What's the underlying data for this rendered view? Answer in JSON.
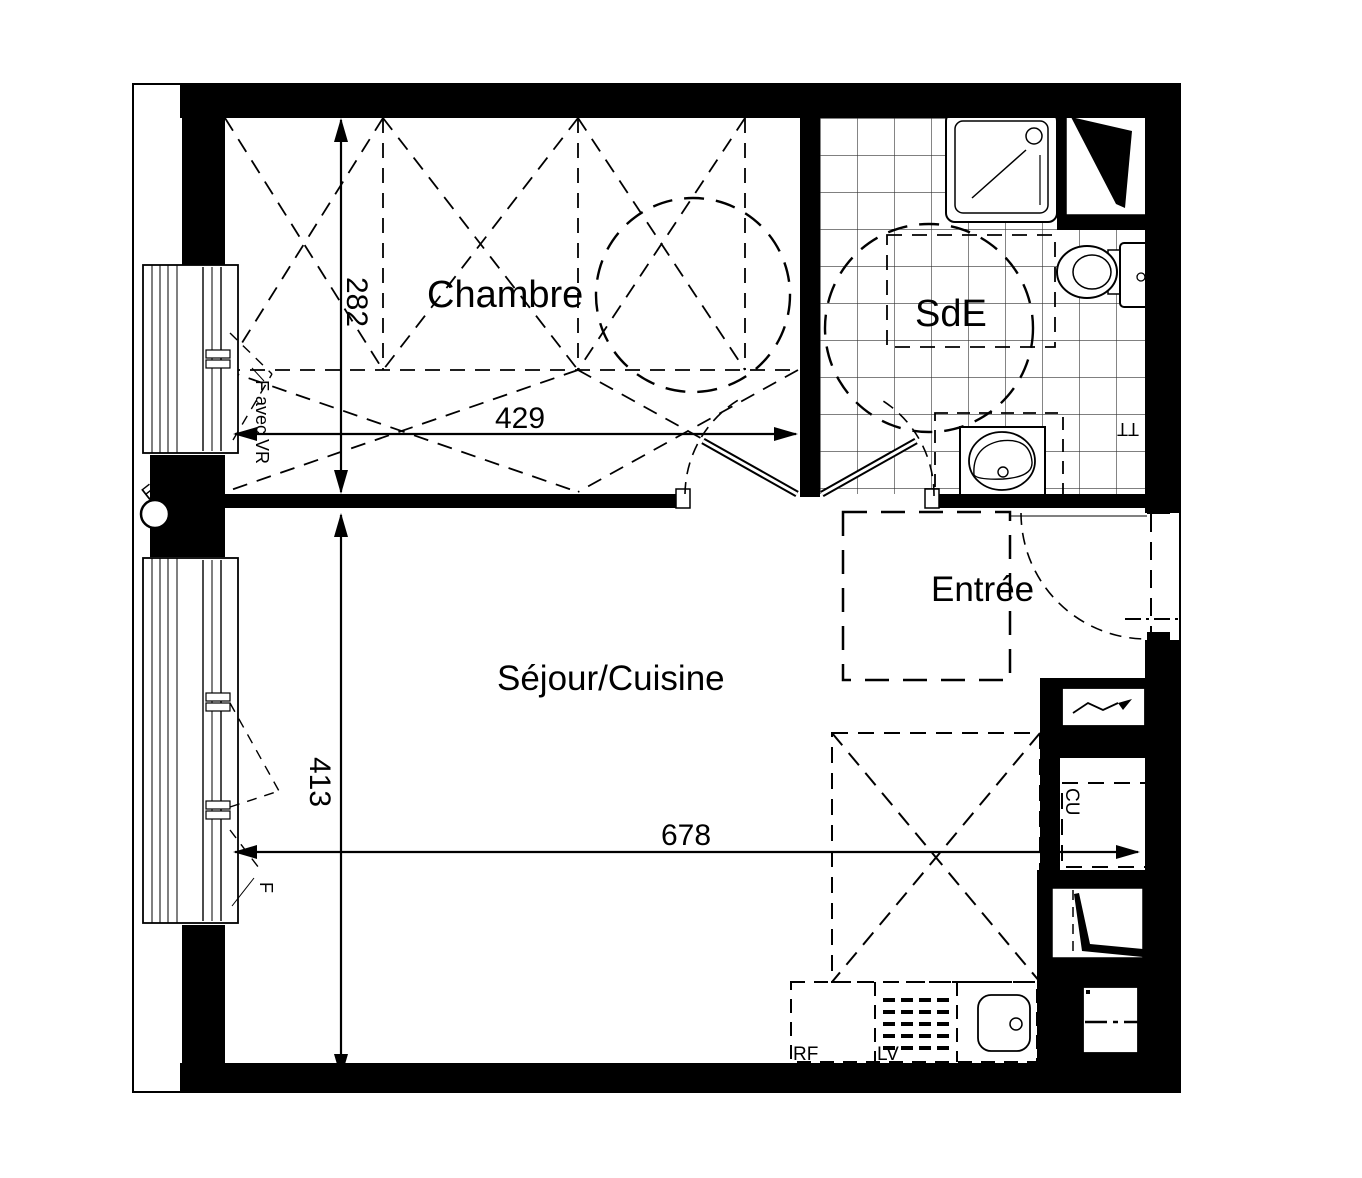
{
  "plan": {
    "rooms": {
      "chambre": "Chambre",
      "sde": "SdE",
      "entree": "Entrée",
      "sejour_cuisine": "Séjour/Cuisine"
    },
    "dimensions": {
      "chambre_height_cm": "282",
      "chambre_width_cm": "429",
      "sejour_height_cm": "413",
      "sejour_width_cm": "678"
    },
    "annotations": {
      "chambre_window": "F avec VR",
      "sejour_window": "F",
      "rainwater_downpipe": "EP",
      "kitchen_column": "CU",
      "towel_dryer": "TT",
      "fridge": "RF",
      "dishwasher": "LV"
    },
    "colors": {
      "line": "#000000",
      "background": "#ffffff",
      "tile_line": "#333333"
    }
  }
}
